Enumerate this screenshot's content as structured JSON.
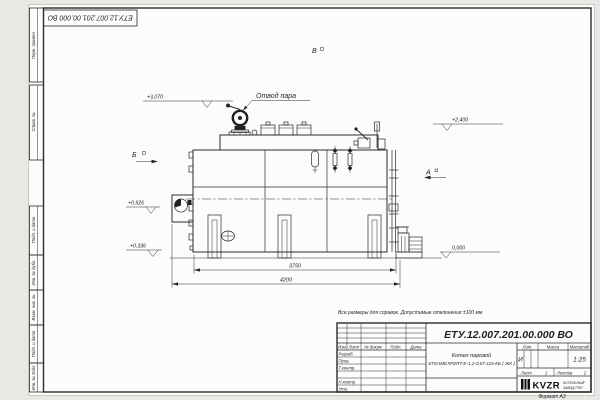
{
  "colors": {
    "line": "#2b2b2b",
    "sheet": "#fcfcfb",
    "background": "#e9e8e5"
  },
  "frame": {
    "top_stamp": "ЕТУ.12.007.201.00.000  ВО",
    "format_note": "Формат А3",
    "margin_labels": [
      "Перв. примен.",
      "Справ. №",
      "Подп. и дата",
      "Инв. № дубл.",
      "Взам. инв. №",
      "Подп. и дата",
      "Инв. № подл."
    ]
  },
  "note": "Все размеры для справок. Допустимые отклонения ±100 мм",
  "drawing": {
    "callout_steam": "Отвод пара",
    "views": {
      "a": "А",
      "b": "Б",
      "v": "В"
    },
    "elevations": {
      "e1": "+3,070",
      "e2": "+2,400",
      "e3": "+0,926",
      "e4": "+0,336",
      "e5": "0,000"
    },
    "dimensions": {
      "d1": "3750",
      "d2": "4200"
    }
  },
  "title_block": {
    "designation": "ЕТУ.12.007.201.00.000  ВО",
    "product_name_1": "Котел паровой",
    "product_name_2": "STEAMEXPERT-Е-1,2-0,07-115-КБ ( ЖК )",
    "col_headers": [
      "Изм",
      "Лист",
      "№ докум.",
      "Подп.",
      "Дата"
    ],
    "sign_labels": [
      "Разраб.",
      "Пров.",
      "Т.контр.",
      "Н.контр.",
      "Утв."
    ],
    "lit_header": "Лит.",
    "mass_header": "Масса",
    "scale_header": "Масштаб",
    "lit_value": "И",
    "scale_value": "1:25",
    "sheet_label": "Лист",
    "sheet_value": "1",
    "sheets_label": "Листов",
    "sheets_value": "2",
    "logo": {
      "name": "KVZR",
      "line1": "КОТЕЛЬНЫЙ",
      "line2": "ЗАВОД РЭП"
    }
  }
}
